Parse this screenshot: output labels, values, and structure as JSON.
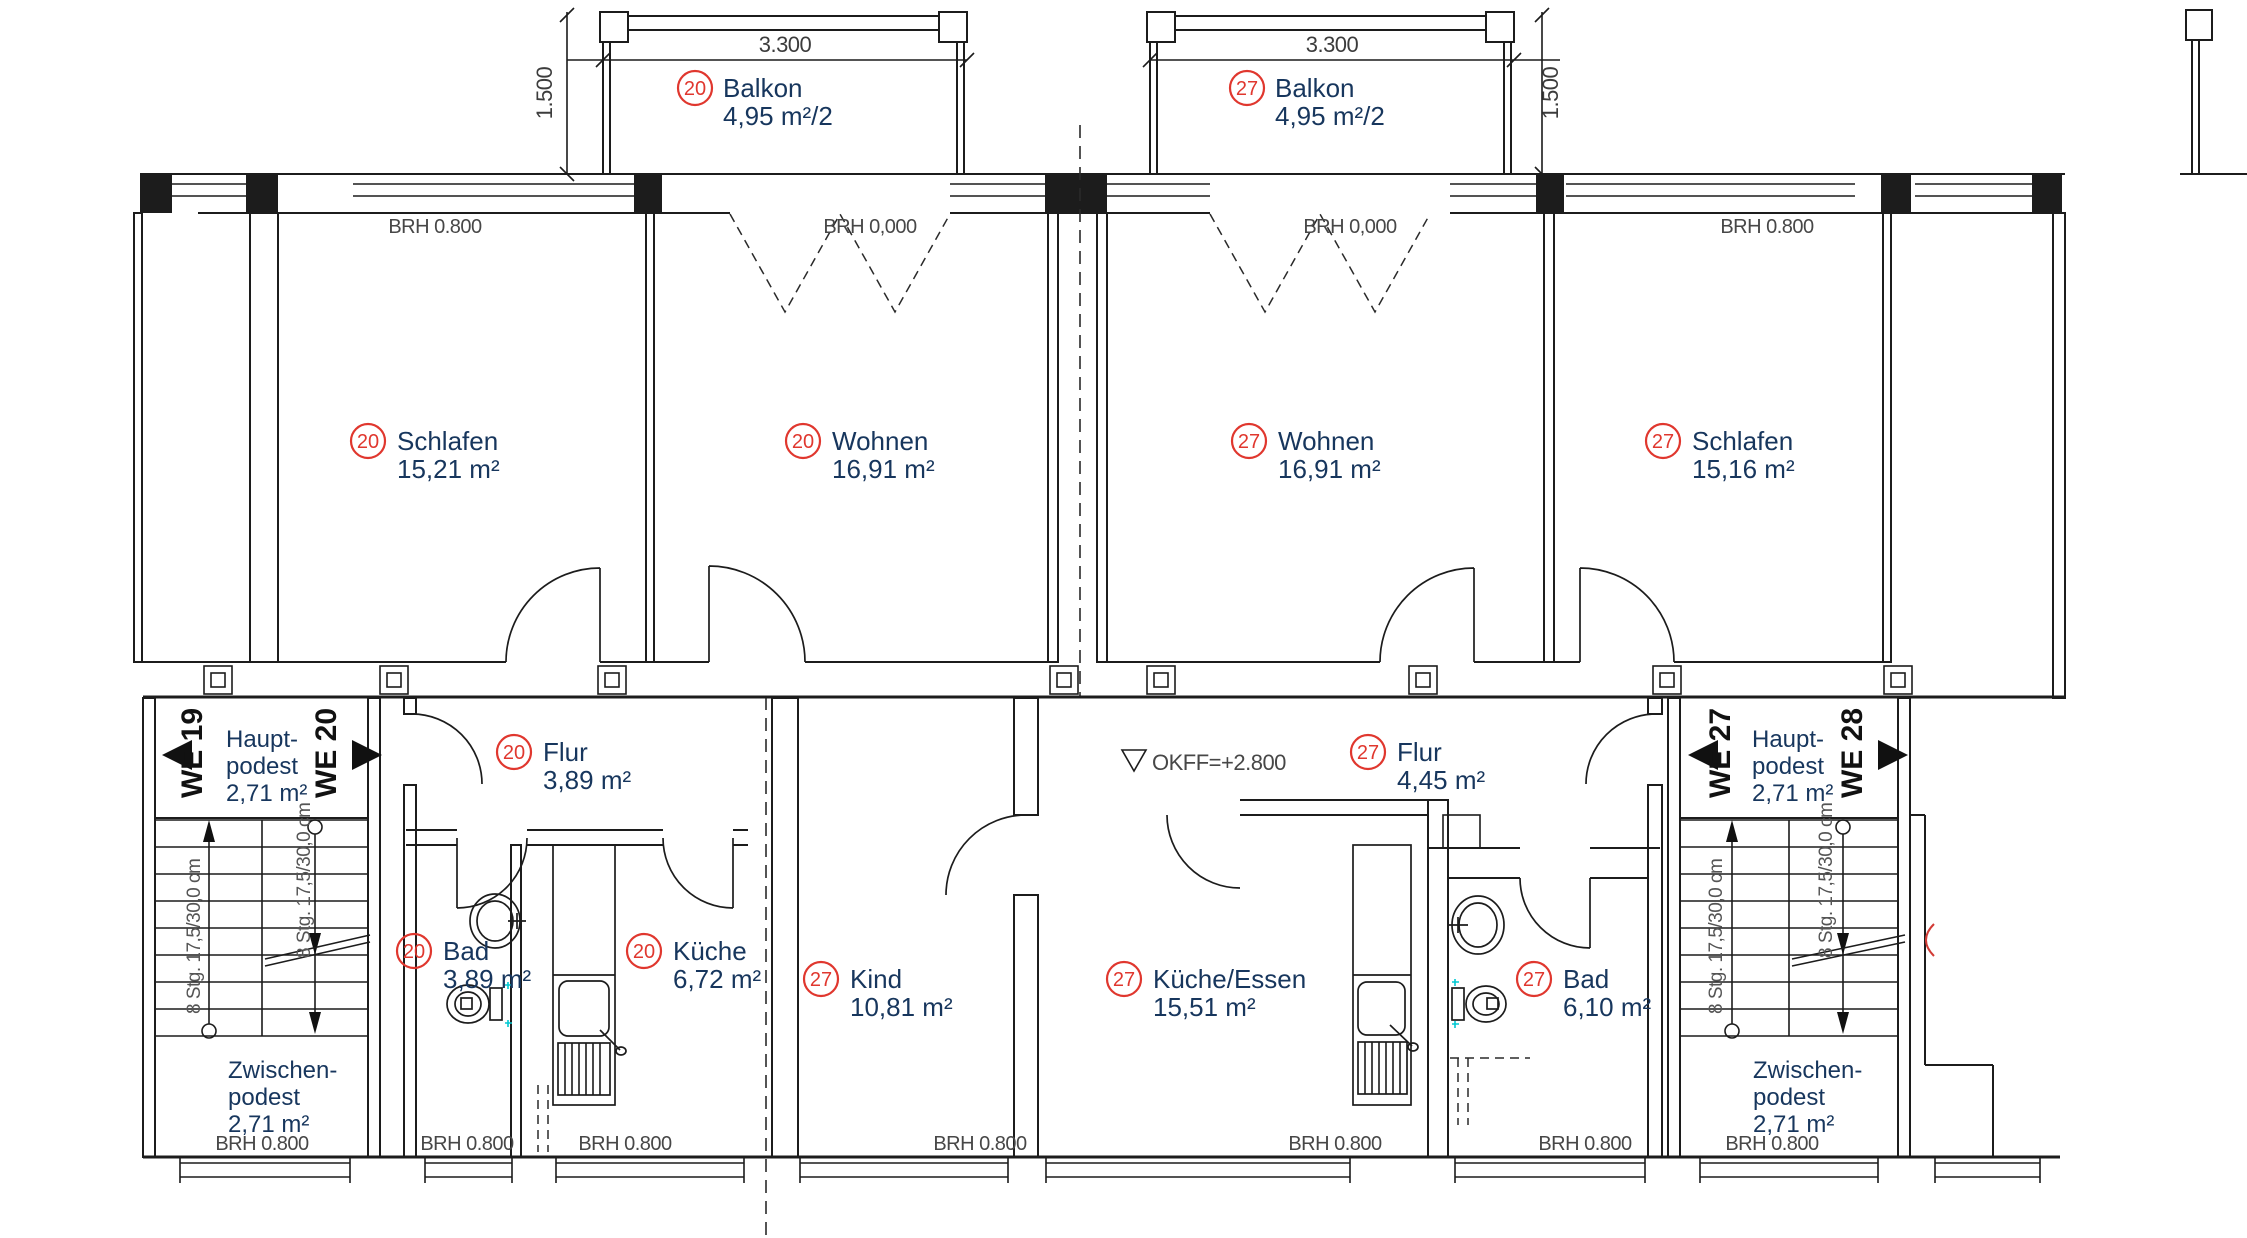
{
  "units": {
    "left": "20",
    "right": "27"
  },
  "rooms": {
    "balkon20": {
      "no": "20",
      "name": "Balkon",
      "area": "4,95 m²/2"
    },
    "schlafen20": {
      "no": "20",
      "name": "Schlafen",
      "area": "15,21 m²"
    },
    "wohnen20": {
      "no": "20",
      "name": "Wohnen",
      "area": "16,91 m²"
    },
    "flur20": {
      "no": "20",
      "name": "Flur",
      "area": "3,89 m²"
    },
    "bad20": {
      "no": "20",
      "name": "Bad",
      "area": "3,89 m²"
    },
    "kueche20": {
      "no": "20",
      "name": "Küche",
      "area": "6,72 m²"
    },
    "balkon27": {
      "no": "27",
      "name": "Balkon",
      "area": "4,95 m²/2"
    },
    "wohnen27": {
      "no": "27",
      "name": "Wohnen",
      "area": "16,91 m²"
    },
    "schlafen27": {
      "no": "27",
      "name": "Schlafen",
      "area": "15,16 m²"
    },
    "flur27": {
      "no": "27",
      "name": "Flur",
      "area": "4,45 m²"
    },
    "kind27": {
      "no": "27",
      "name": "Kind",
      "area": "10,81 m²"
    },
    "kuecheessen27": {
      "no": "27",
      "name": "Küche/Essen",
      "area": "15,51 m²"
    },
    "bad27": {
      "no": "27",
      "name": "Bad",
      "area": "6,10 m²"
    }
  },
  "we": {
    "we19": "WE 19",
    "we20": "WE 20",
    "we27": "WE 27",
    "we28": "WE 28"
  },
  "podest": {
    "haupt": [
      "Haupt-",
      "podest",
      "2,71 m²"
    ],
    "zwischen": [
      "Zwischen-",
      "podest",
      "2,71 m²"
    ]
  },
  "labels": {
    "brh_low": "BRH 0.800",
    "brh_zero": "BRH 0,000",
    "okff": "OKFF=+2.800",
    "stairs": "8 Stg. 17,5/30,0 cm"
  },
  "dims": {
    "width": "3.300",
    "depth": "1.500"
  },
  "colors": {
    "marker_red": "#e0372e",
    "label_blue": "#17365d",
    "wall_black": "#1c1c1c",
    "dim_gray": "#474747"
  }
}
